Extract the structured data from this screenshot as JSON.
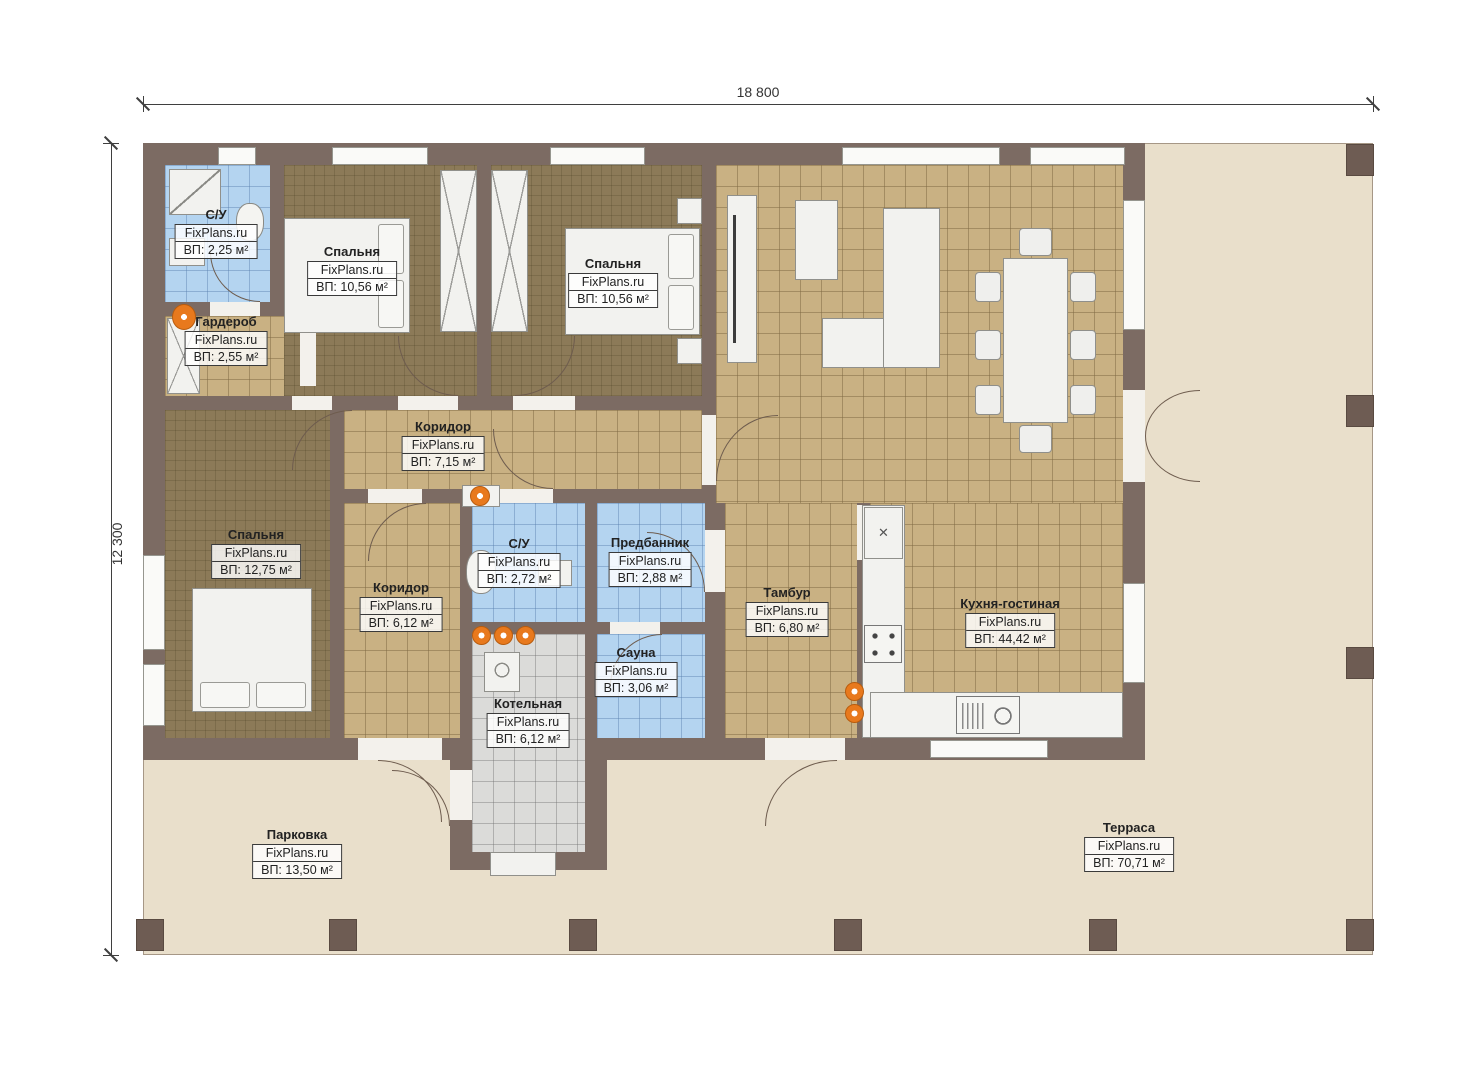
{
  "dimensions": {
    "width": "18 800",
    "height": "12 300"
  },
  "watermark": "FixPlans.ru",
  "icons": {
    "appliance_cross": "✕"
  },
  "rooms": {
    "su1": {
      "name": "С/У",
      "area": "ВП: 2,25 м²"
    },
    "wardrobe": {
      "name": "Гардероб",
      "area": "ВП: 2,55 м²"
    },
    "bedroom1": {
      "name": "Спальня",
      "area": "ВП: 10,56 м²"
    },
    "bedroom2": {
      "name": "Спальня",
      "area": "ВП: 10,56 м²"
    },
    "corridor1": {
      "name": "Коридор",
      "area": "ВП: 7,15 м²"
    },
    "bedroom3": {
      "name": "Спальня",
      "area": "ВП: 12,75 м²"
    },
    "corridor2": {
      "name": "Коридор",
      "area": "ВП: 6,12 м²"
    },
    "su2": {
      "name": "С/У",
      "area": "ВП: 2,72 м²"
    },
    "predbannik": {
      "name": "Предбанник",
      "area": "ВП: 2,88 м²"
    },
    "sauna": {
      "name": "Сауна",
      "area": "ВП: 3,06 м²"
    },
    "boiler": {
      "name": "Котельная",
      "area": "ВП: 6,12 м²"
    },
    "tambur": {
      "name": "Тамбур",
      "area": "ВП: 6,80 м²"
    },
    "kitchen": {
      "name": "Кухня-гостиная",
      "area": "ВП: 44,42 м²"
    },
    "parking": {
      "name": "Парковка",
      "area": "ВП: 13,50 м²"
    },
    "terrace": {
      "name": "Терраса",
      "area": "ВП: 70,71 м²"
    }
  },
  "colors": {
    "wall": "#7c6b63",
    "floor_dark": "#8c7a58",
    "floor_tan": "#c9b183",
    "floor_blue": "#b4d4f0",
    "floor_gray": "#dbdbd9",
    "outdoor": "#e9dfcb",
    "accent_orange": "#e8791d"
  }
}
